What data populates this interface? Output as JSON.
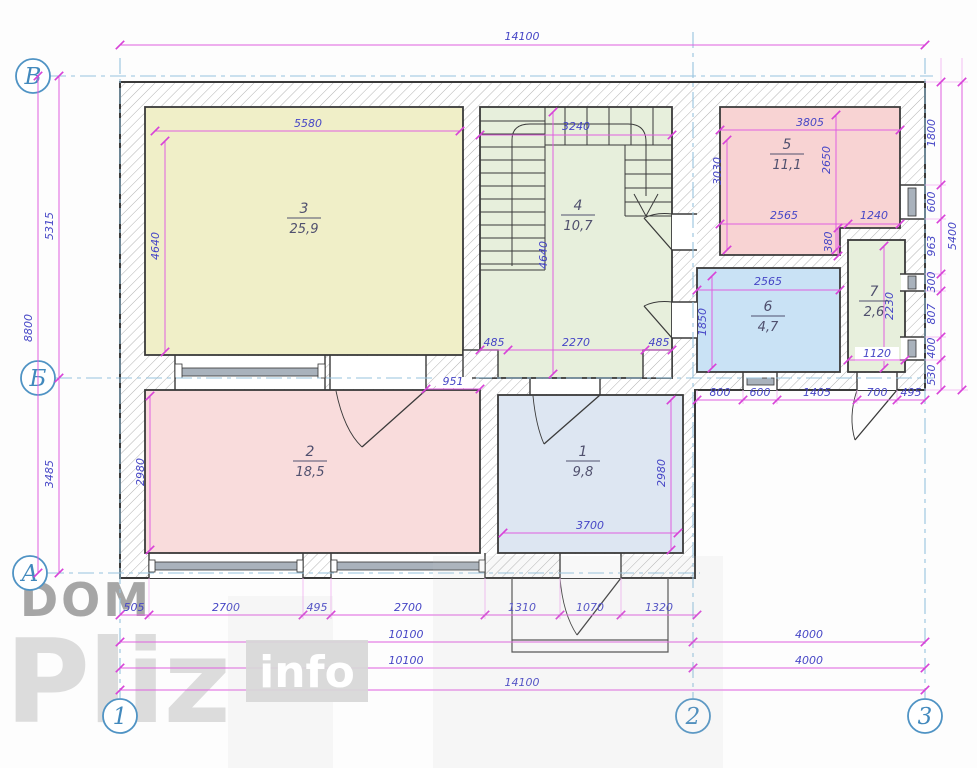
{
  "title": "Floor plan drawing",
  "watermark": {
    "dom": "DOM",
    "pliz": "Pliz",
    "info": "info"
  },
  "axes": {
    "b": "В",
    "bm": "Б",
    "a": "А",
    "c1": "1",
    "c2": "2",
    "c3": "3"
  },
  "rooms": {
    "r1": {
      "num": "1",
      "area": "9,8"
    },
    "r2": {
      "num": "2",
      "area": "18,5"
    },
    "r3": {
      "num": "3",
      "area": "25,9"
    },
    "r4": {
      "num": "4",
      "area": "10,7"
    },
    "r5": {
      "num": "5",
      "area": "11,1"
    },
    "r6": {
      "num": "6",
      "area": "4,7"
    },
    "r7": {
      "num": "7",
      "area": "2,6"
    }
  },
  "colors": {
    "room1": "#dde6f2",
    "room2": "#f9dcdc",
    "room3": "#f0efc8",
    "room4": "#e7efdc",
    "room5": "#f8d3d3",
    "room6": "#c9e2f5",
    "room7": "#e7efdc",
    "dim_line": "#e05fe0",
    "dim_text": "#4646c6",
    "axis": "#4f93c4",
    "wall": "#3a3a3a"
  },
  "dims": {
    "t14100": "14100",
    "l5315": "5315",
    "l8800": "8800",
    "l3485": "3485",
    "r1800": "1800",
    "r600": "600",
    "r963": "963",
    "r300": "300",
    "r807": "807",
    "r400": "400",
    "r530": "530",
    "r5400": "5400",
    "w5580": "5580",
    "h4640a": "4640",
    "w3240": "3240",
    "h4640b": "4640",
    "b485a": "485",
    "b2270": "2270",
    "b485b": "485",
    "w3805": "3805",
    "h3030": "3030",
    "h2650": "2650",
    "w2565a": "2565",
    "w1240": "1240",
    "s380": "380",
    "w2565b": "2565",
    "h1850": "1850",
    "h2230": "2230",
    "w1120": "1120",
    "h2980a": "2980",
    "d951": "951",
    "w3700": "3700",
    "h2980b": "2980",
    "wb800": "800",
    "wb600": "600",
    "wb1405": "1405",
    "wb700": "700",
    "wb495": "495",
    "b505": "505",
    "b2700a": "2700",
    "b495": "495",
    "b2700b": "2700",
    "b1310": "1310",
    "b1070": "1070",
    "b1320": "1320",
    "b10100a": "10100",
    "b4000a": "4000",
    "b10100b": "10100",
    "b4000b": "4000",
    "b14100": "14100"
  }
}
